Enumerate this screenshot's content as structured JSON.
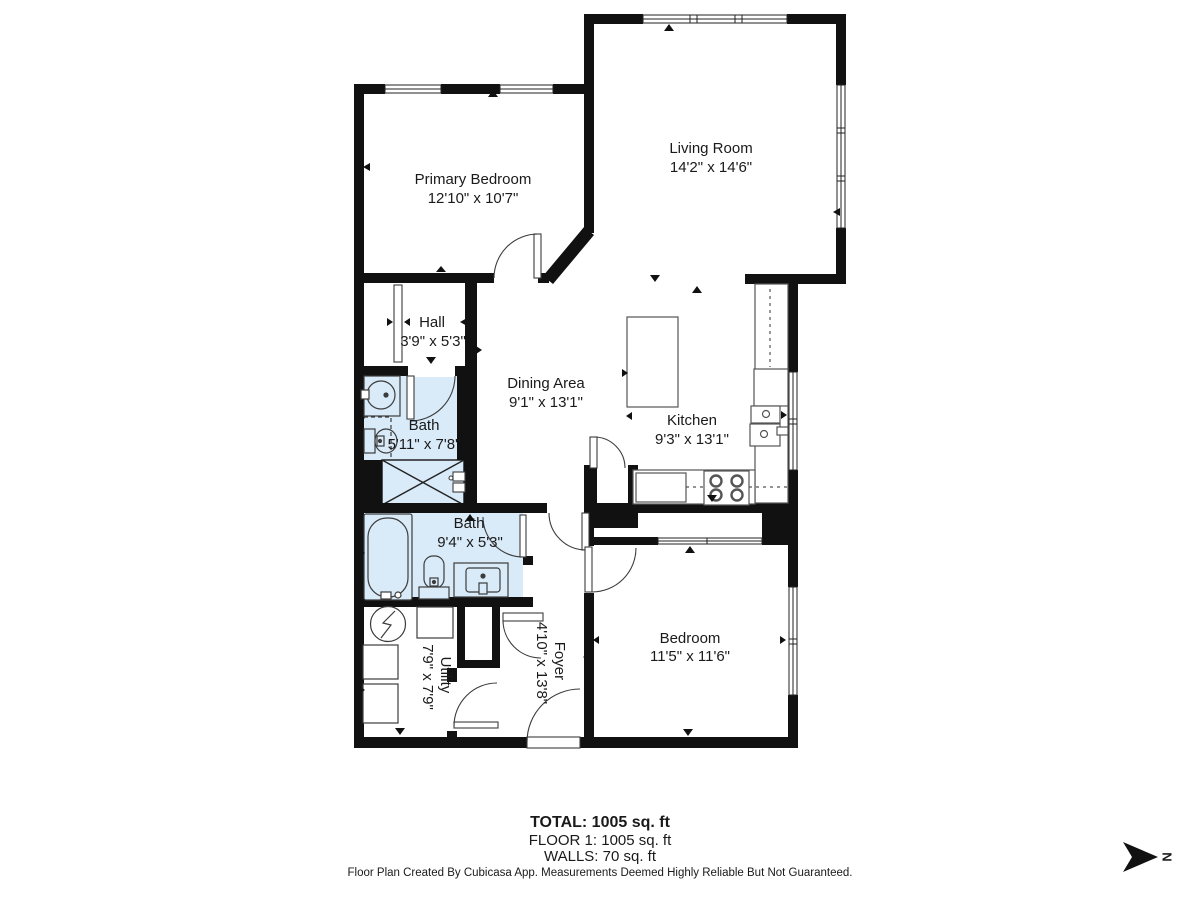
{
  "plan": {
    "rooms": [
      {
        "id": "primary-bedroom",
        "name": "Primary Bedroom",
        "dims": "12'10\" x 10'7\""
      },
      {
        "id": "living-room",
        "name": "Living Room",
        "dims": "14'2\" x 14'6\""
      },
      {
        "id": "hall",
        "name": "Hall",
        "dims": "3'9\" x 5'3\""
      },
      {
        "id": "dining-area",
        "name": "Dining Area",
        "dims": "9'1\" x 13'1\""
      },
      {
        "id": "kitchen",
        "name": "Kitchen",
        "dims": "9'3\" x 13'1\""
      },
      {
        "id": "bath-upper",
        "name": "Bath",
        "dims": "5'11\" x 7'8\""
      },
      {
        "id": "bath-lower",
        "name": "Bath",
        "dims": "9'4\" x 5'3\""
      },
      {
        "id": "bedroom",
        "name": "Bedroom",
        "dims": "11'5\" x 11'6\""
      },
      {
        "id": "utility",
        "name": "Utility",
        "dims": "7'9\" x 7'9\""
      },
      {
        "id": "foyer",
        "name": "Foyer",
        "dims": "4'10\" x 13'8\""
      }
    ],
    "compass_label": "N",
    "summary_total": "TOTAL: 1005 sq. ft",
    "summary_floor": "FLOOR 1: 1005 sq. ft",
    "summary_walls": "WALLS: 70 sq. ft",
    "disclaimer": "Floor Plan Created By Cubicasa App. Measurements Deemed Highly Reliable But Not Guaranteed.",
    "colors": {
      "wall": "#111111",
      "bath_fill": "#d9eaf8",
      "fixture_line": "#3c3c3c"
    }
  }
}
